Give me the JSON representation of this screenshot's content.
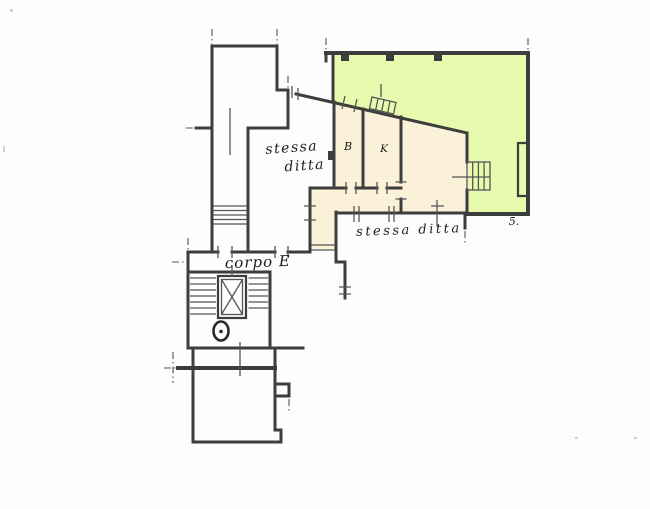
{
  "plan": {
    "type": "cadastral floor plan",
    "colors": {
      "terrace_fill": "#e6f8ac",
      "apartment_fill": "#f9efd7",
      "wall_ink": "#3e3e3e",
      "thin_ink": "#565656",
      "text_ink": "#1f1f1f",
      "background": "#fdfdfd"
    },
    "labels": {
      "adjacent_unit_upper_line1": "stessa",
      "adjacent_unit_upper_line2": "ditta",
      "adjacent_unit_lower": "stessa ditta",
      "building_wing": "corpo E",
      "room_b": "B",
      "room_k": "K",
      "corner_mark": "5."
    }
  }
}
